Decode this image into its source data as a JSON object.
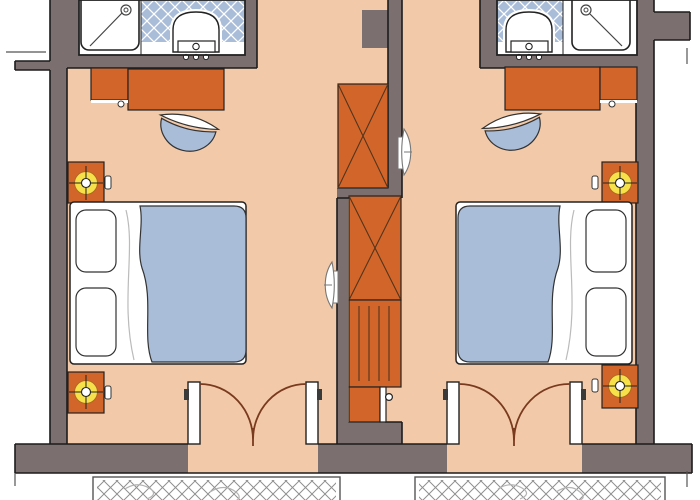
{
  "diagram": {
    "type": "architectural-floor-plan",
    "subject": "Two mirrored hotel guest rooms with en-suite bathrooms, wardrobe niches and balconies"
  },
  "colors": {
    "background": "#ffffff",
    "wall": "#7c6f6f",
    "floor": "#f3caa9",
    "furniture_orange": "#d2662a",
    "bedding_blue": "#a9bdd9",
    "tile_blue": "#a9bdd9",
    "lamp_yellow": "#f6e14b",
    "door_swing": "#7a3a20",
    "outline": "#1c1c1c",
    "hatch_line": "#8f8f8f",
    "sketch_gray": "#b3b3b3",
    "fixture_white": "#ffffff",
    "wardrobe_line": "#53341d"
  },
  "rooms": [
    {
      "id": "left-room",
      "elements": [
        "bathroom",
        "shower-tray",
        "toilet",
        "tiled-floor",
        "desk",
        "side-cabinet",
        "chair",
        "wardrobe",
        "double-bed",
        "pillow",
        "pillow",
        "duvet",
        "nightstand-with-lamp",
        "nightstand-with-lamp",
        "wall-light",
        "double-balcony-door",
        "balcony"
      ]
    },
    {
      "id": "right-room",
      "elements": [
        "bathroom",
        "shower-tray",
        "toilet",
        "tiled-floor",
        "desk",
        "side-cabinet",
        "chair",
        "wardrobe",
        "shelf-unit",
        "minibar",
        "double-bed",
        "pillow",
        "pillow",
        "duvet",
        "nightstand-with-lamp",
        "nightstand-with-lamp",
        "wall-light",
        "double-balcony-door",
        "balcony"
      ]
    }
  ]
}
